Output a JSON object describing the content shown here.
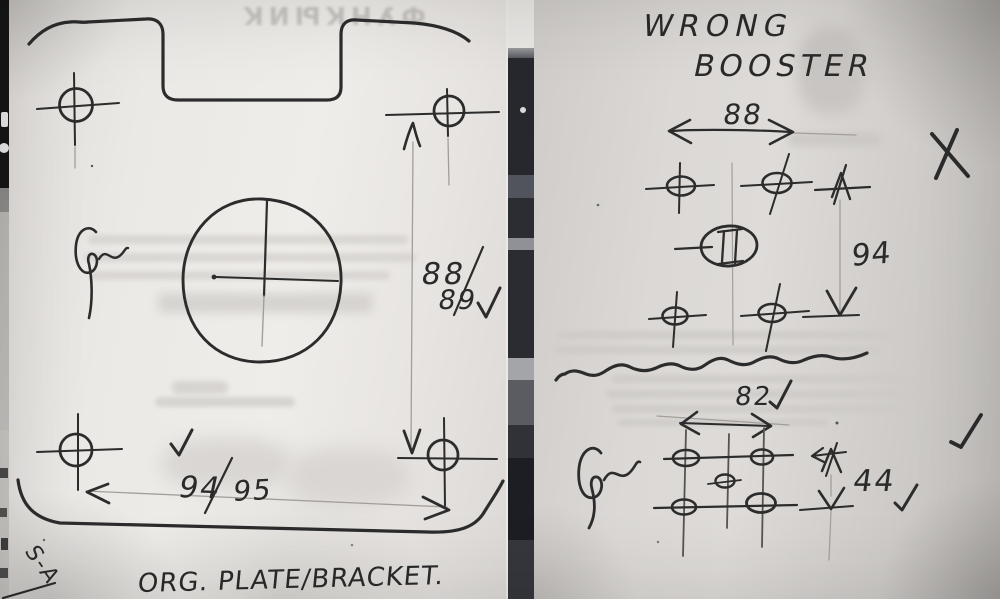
{
  "left_sketch": {
    "caption": "ORG. PLATE/BRACKET.",
    "corner_mark": "S-A",
    "vertical_dim": {
      "numerator": "88",
      "denominator": "89",
      "status": "checked"
    },
    "horizontal_dim": {
      "numerator": "94",
      "denominator": "95",
      "status": "checked"
    }
  },
  "right_sketch": {
    "title_line1": "WRONG",
    "title_line2": "BOOSTER",
    "upper": {
      "width": "88",
      "height": "94",
      "center_symbol": "II",
      "verdict": "rejected-x"
    },
    "lower": {
      "width": "82",
      "height": "44",
      "verdict": "checked"
    }
  },
  "ghost": {
    "header": "ФУНКЫИК"
  },
  "palette": {
    "ink": "#2c2c2c",
    "pencil": "#a29f9b",
    "paper_left": "#ebe9e6",
    "paper_right": "#d7d4d1",
    "magazine_strip": "#26282e"
  }
}
